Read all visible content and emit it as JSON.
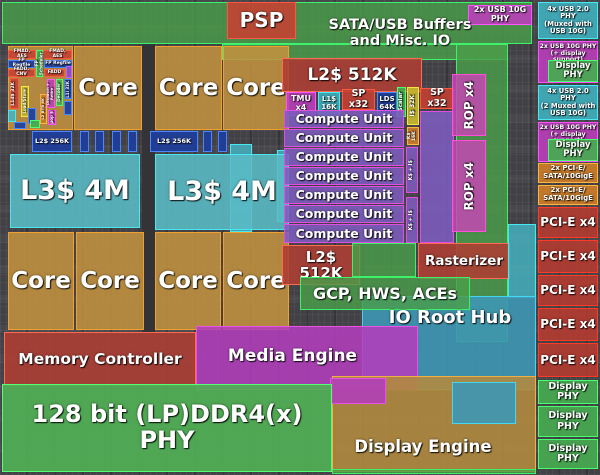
{
  "die": {
    "top": {
      "psp": "PSP",
      "sata_usb": "SATA/USB Buffers\nand Misc. IO",
      "usb10g": "2x USB 10G PHY"
    },
    "cpu": {
      "core": "Core",
      "l3": "L3$ 4M",
      "l2": "L2$ 256K",
      "micro": {
        "fmad_aes": "FMAD, AES",
        "fp_regfile": "FP Regfile",
        "fadd_cnv": "FADD, CNV",
        "fadd": "FADD",
        "fp_scheduler": "FP Scheduler",
        "l1d": "L1d$ 32K",
        "load_store": "Load/Store",
        "l2_btb": "L2 BTB 6K",
        "dispatch_retire": "Dispatch + Retire",
        "decoder": "Decoder",
        "l1i": "L1i 32K",
        "uop": "µop $"
      }
    },
    "gpu": {
      "l2_512k": "L2$ 512K",
      "tmu": "TMU x4",
      "l1_16k": "L1$ 16K",
      "sp_x32": "SP x32",
      "lds_64k": "LDS 64K",
      "scalar": "Scalar",
      "i_32k": "I$ 32K",
      "k_16k": "K$ 16K",
      "compute_unit": "Compute Unit",
      "ks_is": "K$ + I$",
      "rop_x4": "ROP x4",
      "rasterizer": "Rasterizer",
      "gcp_hws_aces": "GCP, HWS, ACEs"
    },
    "soc": {
      "io_root_hub": "IO Root Hub",
      "media_engine": "Media Engine",
      "memory_controller": "Memory Controller",
      "ddr_phy": "128 bit (LP)DDR4(x) PHY",
      "display_engine": "Display Engine"
    },
    "io_col": {
      "usb2_muxed": "4x USB 2.0 PHY\n(Muxed with USB 10G)",
      "usb10g_display": "2x USB 10G PHY\n(+ display support)",
      "display_phy": "Display PHY",
      "usb2_muxed2": "4x USB 2.0 PHY\n(2 Muxed with USB 10G)",
      "pcie_sata_10gige": "2x PCI-E/\nSATA/10GigE",
      "pcie_x4": "PCI-E x4"
    },
    "palette": {
      "core": "#c79a45",
      "l3_cache": "#64c2cc",
      "compute_unit": "#8258c2",
      "rop": "#c847b2",
      "io_green": "#4aa050",
      "cyan_usb": "#43b4c2",
      "magenta_usb": "#c03ec0",
      "pcie_red": "#b63a30",
      "pcie_sata_orange": "#cd7d28",
      "ddr_phy_green": "#50af55",
      "media_magenta": "#b23ebc",
      "io_root_hub_blue": "#3e96b4",
      "memory_red": "#ac3e34",
      "display_tan": "#b08a3e",
      "l2_blue": "#1e3e9b"
    }
  }
}
